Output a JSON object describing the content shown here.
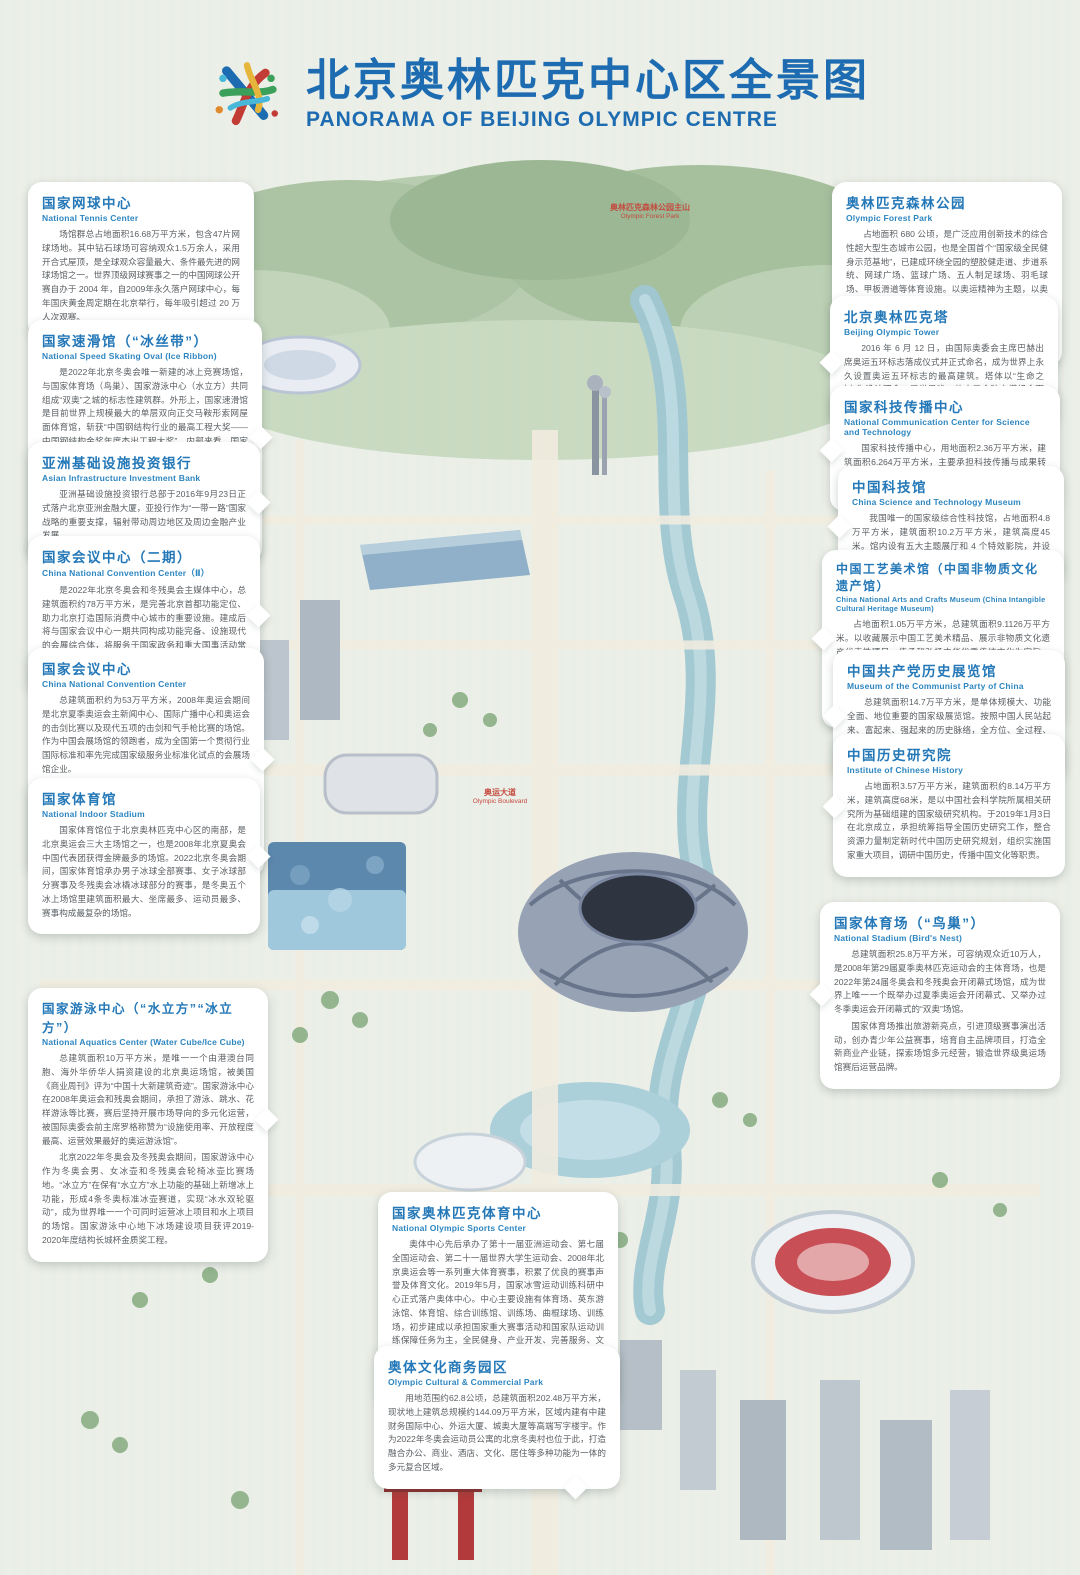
{
  "theme": {
    "title_blue": "#1d6bb0",
    "heading_blue": "#2478b8",
    "body_gray": "#5a5f63",
    "map_label_red": "#c44a3f",
    "background": "#e7ece4"
  },
  "header": {
    "title_zh": "北京奥林匹克中心区全景图",
    "title_en": "PANORAMA OF BEIJING OLYMPIC CENTRE",
    "logo": "olympic-centre-logo"
  },
  "map_labels": [
    {
      "zh": "奥林匹克森林公园主山",
      "en": "Olympic Forest Park"
    },
    {
      "zh": "奥运大道",
      "en": "Olympic Boulevard"
    }
  ],
  "callouts": [
    {
      "title_zh": "国家网球中心",
      "title_en": "National Tennis Center",
      "body": [
        "场馆群总占地面积16.68万平方米，包含47片网球场地。其中钻石球场可容纳观众1.5万余人，采用开合式屋顶，是全球观众容量最大、条件最先进的网球场馆之一。世界顶级网球赛事之一的中国网球公开赛自办于 2004 年，自2009年永久落户网球中心，每年国庆黄金周定期在北京举行，每年吸引超过 20 万人次观赛。"
      ]
    },
    {
      "title_zh": "奥林匹克森林公园",
      "title_en": "Olympic Forest Park",
      "body": [
        "占地面积 680 公顷，是广泛应用创新技术的综合性超大型生态城市公园，也是全国首个“国家级全民健身示范基地”，已建成环绕全园的塑胶健走道、步道系统、网球广场、篮球广场、五人制足球场、羽毛球场、甲板滑道等体育设施。以奥运精神为主题，以奥运文化与中国精神相融合的生态公园为依托，打造以青少年科普及爱国教育、生态涵养与观摩、文化演出与交流、休闲健身与体验为主要内容的国际化示范公园。"
      ]
    },
    {
      "title_zh": "国家速滑馆（“冰丝带”）",
      "title_en": "National Speed Skating Oval (Ice Ribbon)",
      "body": [
        "是2022年北京冬奥会唯一新建的冰上竞赛场馆，与国家体育场（鸟巢）、国家游泳中心（水立方）共同组成“双奥”之城的标志性建筑群。外形上，国家速滑馆是目前世界上规模最大的单层双向正交马鞍形索网屋面体育馆，斩获“中国钢结构行业的最高工程大奖——中国钢结构金奖年度杰出工程大奖”。内部来看，国家速滑馆拥有亚洲最大的全冰面设计，冰面面积达1.2万平方米，可接待超过2000人同时开展冰球、速度滑冰、花样滑冰、冰壶等各种冰上运动。",
        "场馆在冬奥会时承担速度滑冰项目的比赛和训练，成为奥林匹克中心区中的新地标。赛后对市民开放，既为运动员提供训练场地，也能满足北京市民冰雪运动的需求。"
      ]
    },
    {
      "title_zh": "北京奥林匹克塔",
      "title_en": "Beijing Olympic Tower",
      "body": [
        "2016 年 6 月 12 日，由国际奥委会主席巴赫出席奥运五环标志落成仪式并正式命名，成为世界上永久设置奥运五环标志的最高建筑。塔体以“生命之树”为设计理念，是世界唯一的由五个独立塔组合而成。"
      ]
    },
    {
      "title_zh": "国家科技传播中心",
      "title_en": "National Communication Center for Science and Technology",
      "body": [
        "国家科技传播中心，用地面积2.36万平方米，建筑面积6.264万平方米，主要承担科技传播与成果转化、创新创业服务、科学文化展示（中国科学家博物馆）、互联网+科技传播四大功能。"
      ]
    },
    {
      "title_zh": "中国科技馆",
      "title_en": "China Science and Technology Museum",
      "body": [
        "我国唯一的国家级综合性科技馆，占地面积4.8万平方米，建筑面积10.2万平方米，建筑高度45 米。馆内设有五大主题展厅和 4 个特效影院，并设有多间实验室、科普报告厅及多功能厅。"
      ]
    },
    {
      "title_zh": "中国工艺美术馆（中国非物质文化遗产馆）",
      "title_en": "China National Arts and Crafts Museum (China Intangible Cultural Heritage Museum)",
      "body": [
        "占地面积1.05万平方米，总建筑面积9.1126万平方米。以收藏展示中国工艺美术精品、展示非物质文化遗产代表性项目、传承和弘扬中华优秀传统文化为宗旨，以开展中国工艺美术、非物质文化遗产研究，数字化保护展示，中国工艺美术、非物质文化遗产代表性精品征集、收藏、鉴定，举办相关展览、演出，开展国内外交流合作等为主体业务。"
      ]
    },
    {
      "title_zh": "中国共产党历史展览馆",
      "title_en": "Museum of  the Communist Party of China",
      "body": [
        "总建筑面积14.7万平方米，是单体规模大、功能全面、地位重要的国家级展览馆。按照中国人民站起来、富起来、强起来的历史脉络，全方位、全过程、全景式、史诗般宣传展示中国共产党一百年的光辉历史。"
      ]
    },
    {
      "title_zh": "中国历史研究院",
      "title_en": "Institute of Chinese History",
      "body": [
        "占地面积3.57万平方米，建筑面积约8.14万平方米，建筑高度68米，是以中国社会科学院所属相关研究所为基础组建的国家级研究机构。于2019年1月3日在北京成立，承担统筹指导全国历史研究工作，整合资源力量制定新时代中国历史研究规划，组织实施国家重大项目，调研中国历史，传播中国文化等职责。"
      ]
    },
    {
      "title_zh": "亚洲基础设施投资银行",
      "title_en": "Asian Infrastructure Investment Bank",
      "body": [
        "亚洲基础设施投资银行总部于2016年9月23日正式落户北京亚洲金融大厦，亚投行作为“一带一路”国家战略的重要支撑，辐射带动周边地区及周边金融产业发展。"
      ]
    },
    {
      "title_zh": "国家会议中心（二期）",
      "title_en": "China National Convention Center（Ⅱ）",
      "body": [
        "是2022年北京冬奥会和冬残奥会主媒体中心，总建筑面积约78万平方米，是完善北京首都功能定位、助力北京打造国际消费中心城市的重要设施。建成后将与国家会议中心一期共同构成功能完备、设施现代的会展综合体，将服务于国家政务和重大国事活动常态化需要，为推进首都国际交往中心建设做出重大贡献。"
      ]
    },
    {
      "title_zh": "国家会议中心",
      "title_en": "China National Convention Center",
      "body": [
        "总建筑面积约为53万平方米，2008年奥运会期间是北京夏季奥运会主新闻中心、国际广播中心和奥运会的击剑比赛以及现代五项的击剑和气手枪比赛的场馆。作为中国会展场馆的领跑者，成为全国第一个贯彻行业国际标准和率先完成国家级服务业标准化试点的会展场馆企业。",
        "国家会议中心累计接待会展活动近万场，其中包括APEC领导人会议周、“一带一路”国际合作高峰论坛、中国国际服务贸易交易会、国际冬季运动（北京）博览会等国际重大活动，是国际大会及会议协会（ICCA）、国际会议中心协会（AIPC）、国际展览业协会（UFI）会员，被广泛认为是奥运场馆赛后利用的典范。"
      ]
    },
    {
      "title_zh": "国家体育馆",
      "title_en": "National Indoor Stadium",
      "body": [
        "国家体育馆位于北京奥林匹克中心区的南部，是北京奥运会三大主场馆之一，也是2008年北京夏奥会中国代表团获得金牌最多的场馆。2022北京冬奥会期间，国家体育馆承办男子冰球全部赛事、女子冰球部分赛事及冬残奥会冰橇冰球部分的赛事，是冬奥五个冰上场馆里建筑面积最大、坐席最多、运动员最多、赛事构成最复杂的场馆。"
      ]
    },
    {
      "title_zh": "国家游泳中心（“水立方”“冰立方”）",
      "title_en": "National Aquatics Center (Water Cube/Ice Cube)",
      "body": [
        "总建筑面积10万平方米，是唯一一个由港澳台同胞、海外华侨华人捐资建设的北京奥运场馆，被美国《商业周刊》评为“中国十大新建筑奇迹”。国家游泳中心在2008年奥运会和残奥会期间，承担了游泳、跳水、花样游泳等比赛，赛后坚持开展市场导向的多元化运营，被国际奥委会前主席罗格称赞为“设施使用率、开放程度最高、运营效果最好的奥运游泳馆”。",
        "北京2022年冬奥会及冬残奥会期间，国家游泳中心作为冬奥会男、女冰壶和冬残奥会轮椅冰壶比赛场地。“冰立方”在保有“水立方”水上功能的基础上新增冰上功能，形成4条冬奥标准冰壶赛道，实现“冰水双轮驱动”，成为世界唯一一个可同时运营冰上项目和水上项目的场馆。国家游泳中心地下冰场建设项目获评2019-2020年度结构长城杯金质奖工程。"
      ]
    },
    {
      "title_zh": "国家体育场（“鸟巢”）",
      "title_en": "National Stadium (Bird's Nest)",
      "body": [
        "总建筑面积25.8万平方米，可容纳观众近10万人，是2008年第29届夏季奥林匹克运动会的主体育场，也是2022年第24届冬奥会和冬残奥会开闭幕式场馆，成为世界上唯一一个既举办过夏季奥运会开闭幕式、又举办过冬季奥运会开闭幕式的“双奥”场馆。",
        "国家体育场推出旅游新亮点，引进顶级赛事演出活动，创办青少年公益赛事，培育自主品牌项目，打造全新商业产业链，探索场馆多元经营，锻造世界级奥运场馆赛后运营品牌。"
      ]
    },
    {
      "title_zh": "国家奥林匹克体育中心",
      "title_en": "National Olympic Sports Center",
      "body": [
        "奥体中心先后承办了第十一届亚洲运动会、第七届全国运动会、第二十一届世界大学生运动会、2008年北京奥运会等一系列重大体育赛事，积累了优良的赛事声誉及体育文化。2019年5月，国家冰雪运动训练科研中心正式落户奥体中心。中心主要设施有体育场、英东游泳馆、体育馆、综合训练馆、训练场、曲棍球场、训练场，初步建成以承担国家重大赛事活动和国家队运动训练保障任务为主，全民健身、产业开发、完善服务、文化建设协同发展的综合性中心，有30余支全国各类队伍驻训，推动建设“训、科、医、教、服”一体化新型国家体育训练中心。"
      ]
    },
    {
      "title_zh": "奥体文化商务园区",
      "title_en": "Olympic Cultural & Commercial Park",
      "body": [
        "用地范围约62.8公顷，总建筑面积202.48万平方米，现状地上建筑总规模约144.09万平方米，区域内建有中建财务国际中心、外运大厦、城奥大厦等高端写字楼宇。作为2022年冬奥会运动员公寓的北京冬奥村也位于此，打造融合办公、商业、酒店、文化、居住等多种功能为一体的多元复合区域。"
      ]
    }
  ]
}
